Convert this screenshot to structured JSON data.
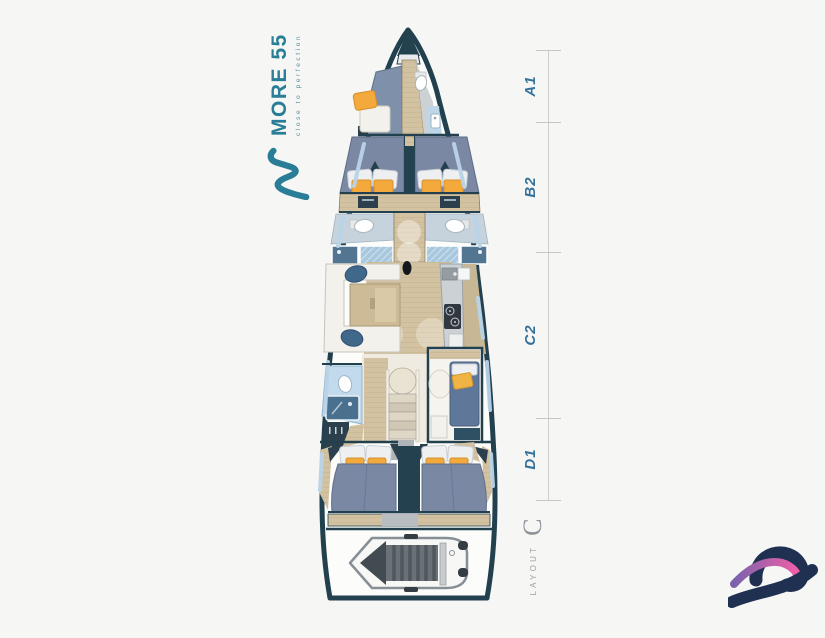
{
  "page": {
    "background_color": "#f6f6f4"
  },
  "brand": {
    "name": "MORE 55",
    "tagline": "close to perfection",
    "accent_color": "#2a7d96",
    "mark": "wave-m-icon"
  },
  "dimension_scale": {
    "sections": [
      {
        "label": "A1"
      },
      {
        "label": "B2"
      },
      {
        "label": "C2"
      },
      {
        "label": "D1"
      }
    ]
  },
  "layout_badge": {
    "word": "LAYOUT",
    "variant": "C"
  },
  "floorplan_colors": {
    "hull_outline": "#22404e",
    "wood_floor": "#d3c2a1",
    "mattress_blue": "#7b88a4",
    "cushion_orange": "#f3a93c",
    "pillow_yellow": "#f0b445",
    "bathroom_blue": "#c2dbec",
    "shower_blue": "#527691",
    "counter_gray": "#cbd1d4"
  },
  "footer_logo": {
    "name": "wave-logo-icon",
    "navy": "#1f3050",
    "pink": "#ee5fa7",
    "purple": "#7a63ad"
  }
}
